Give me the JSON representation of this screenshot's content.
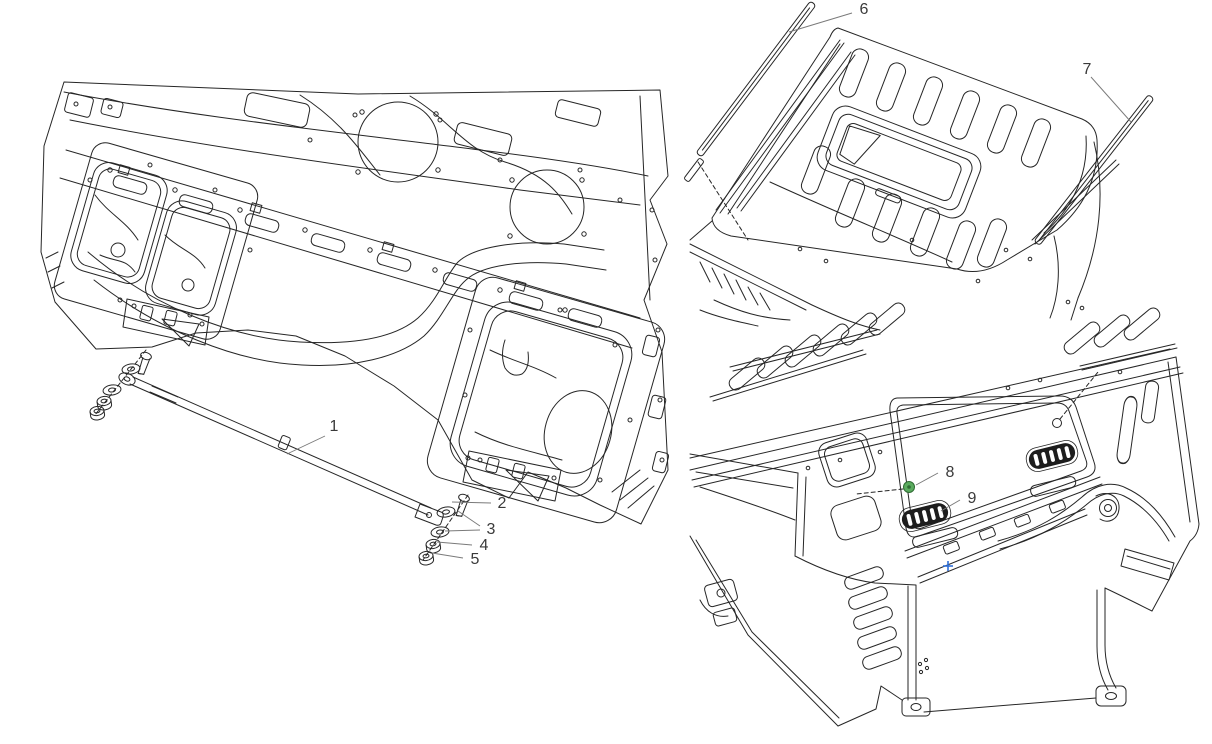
{
  "figure": {
    "kind": "truck-cab exploded parts diagram",
    "background": "#ffffff",
    "line_color": "#262626",
    "leader_color": "#7a7a7a",
    "label_color": "#3a3a3a",
    "accent_green": "#5aab5e",
    "accent_green_dark": "#2f6b33",
    "accent_blue": "#2f6fd8"
  },
  "views": [
    {
      "id": "floor",
      "name": "cab-underbody-front-view",
      "callout_ids": [
        "1",
        "2",
        "3",
        "4",
        "5"
      ]
    },
    {
      "id": "roof",
      "name": "cab-roof-top-view",
      "callout_ids": [
        "6",
        "7"
      ]
    },
    {
      "id": "rear",
      "name": "cab-rear-view",
      "callout_ids": [
        "8",
        "9"
      ]
    }
  ],
  "callouts": [
    {
      "label": "1",
      "x": 334,
      "y": 431,
      "leaders": [
        [
          325,
          436,
          287,
          454
        ]
      ]
    },
    {
      "label": "2",
      "x": 502,
      "y": 508,
      "leaders": [
        [
          491,
          503,
          452,
          502
        ]
      ]
    },
    {
      "label": "3",
      "x": 491,
      "y": 534,
      "leaders": [
        [
          480,
          526,
          458,
          511
        ],
        [
          480,
          530,
          445,
          531
        ]
      ]
    },
    {
      "label": "4",
      "x": 484,
      "y": 550,
      "leaders": [
        [
          472,
          545,
          437,
          542
        ]
      ]
    },
    {
      "label": "5",
      "x": 475,
      "y": 564,
      "leaders": [
        [
          463,
          558,
          432,
          553
        ]
      ]
    },
    {
      "label": "6",
      "x": 864,
      "y": 14,
      "leaders": [
        [
          852,
          13,
          789,
          32
        ]
      ]
    },
    {
      "label": "7",
      "x": 1087,
      "y": 74,
      "leaders": [
        [
          1091,
          77,
          1131,
          122
        ]
      ]
    },
    {
      "label": "8",
      "x": 950,
      "y": 477,
      "leaders": [
        [
          938,
          473,
          916,
          485
        ]
      ]
    },
    {
      "label": "9",
      "x": 972,
      "y": 503,
      "leaders": [
        [
          960,
          500,
          941,
          511
        ]
      ]
    }
  ],
  "markers": [
    {
      "name": "grommet-part-8",
      "shape": "circle",
      "x": 909,
      "y": 487,
      "r": 5.5
    },
    {
      "name": "datum-cross-blue",
      "shape": "cross",
      "x": 948,
      "y": 566,
      "size": 5
    }
  ],
  "dashed_references": [
    [
      903,
      489,
      856,
      494
    ],
    [
      1060,
      419,
      1098,
      372
    ]
  ]
}
